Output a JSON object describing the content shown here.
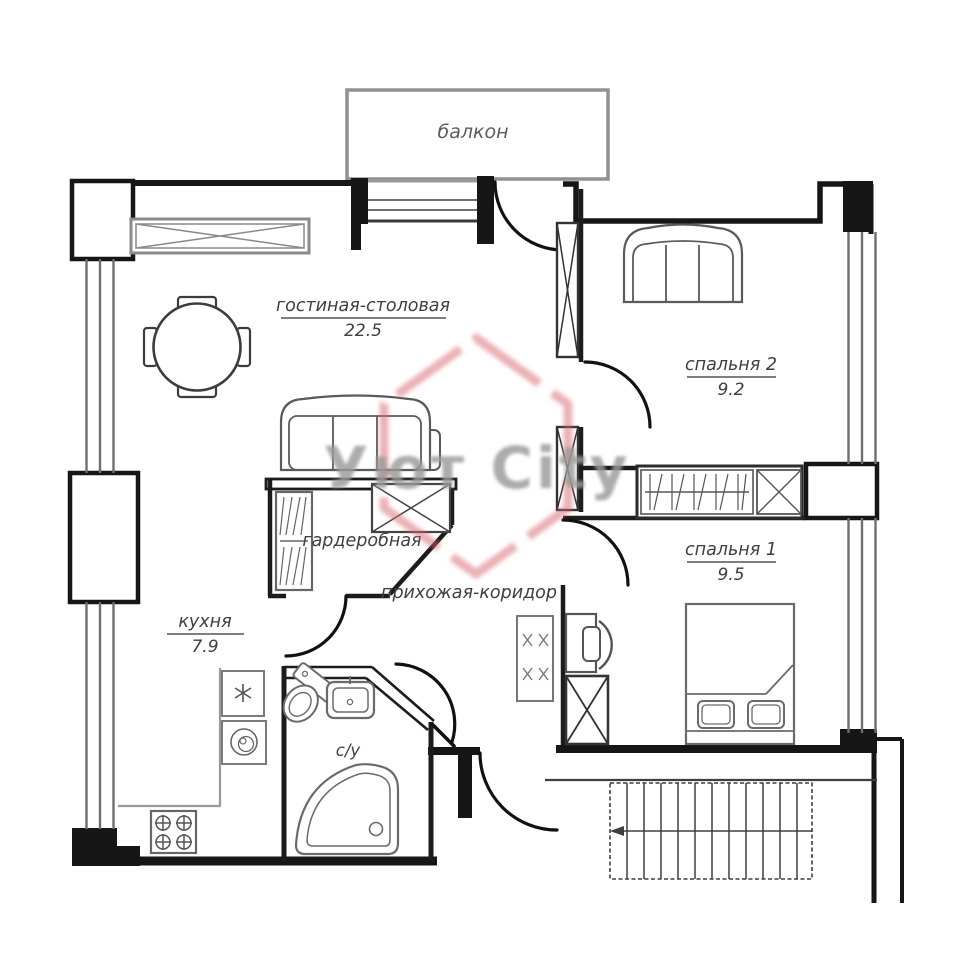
{
  "title": "apartment-floor-plan",
  "rooms": {
    "balcony": {
      "label": "балкон"
    },
    "living": {
      "label": "гостиная-столовая",
      "area": "22.5"
    },
    "bedroom2": {
      "label": "спальня 2",
      "area": "9.2"
    },
    "bedroom1": {
      "label": "спальня 1",
      "area": "9.5"
    },
    "wardrobe": {
      "label": "гардеробная"
    },
    "hallway": {
      "label": "прихожая-коридор"
    },
    "kitchen": {
      "label": "кухня",
      "area": "7.9"
    },
    "bathroom": {
      "label": "с/у"
    }
  },
  "watermark": {
    "text": "Уют City"
  },
  "colors": {
    "wall": "#161616",
    "furniture": "#5a5a5a",
    "window": "#6e6e6e",
    "label": "#3f3f3f",
    "watermark_accent": "#d5636b",
    "watermark_text": "#9a9a9a"
  }
}
